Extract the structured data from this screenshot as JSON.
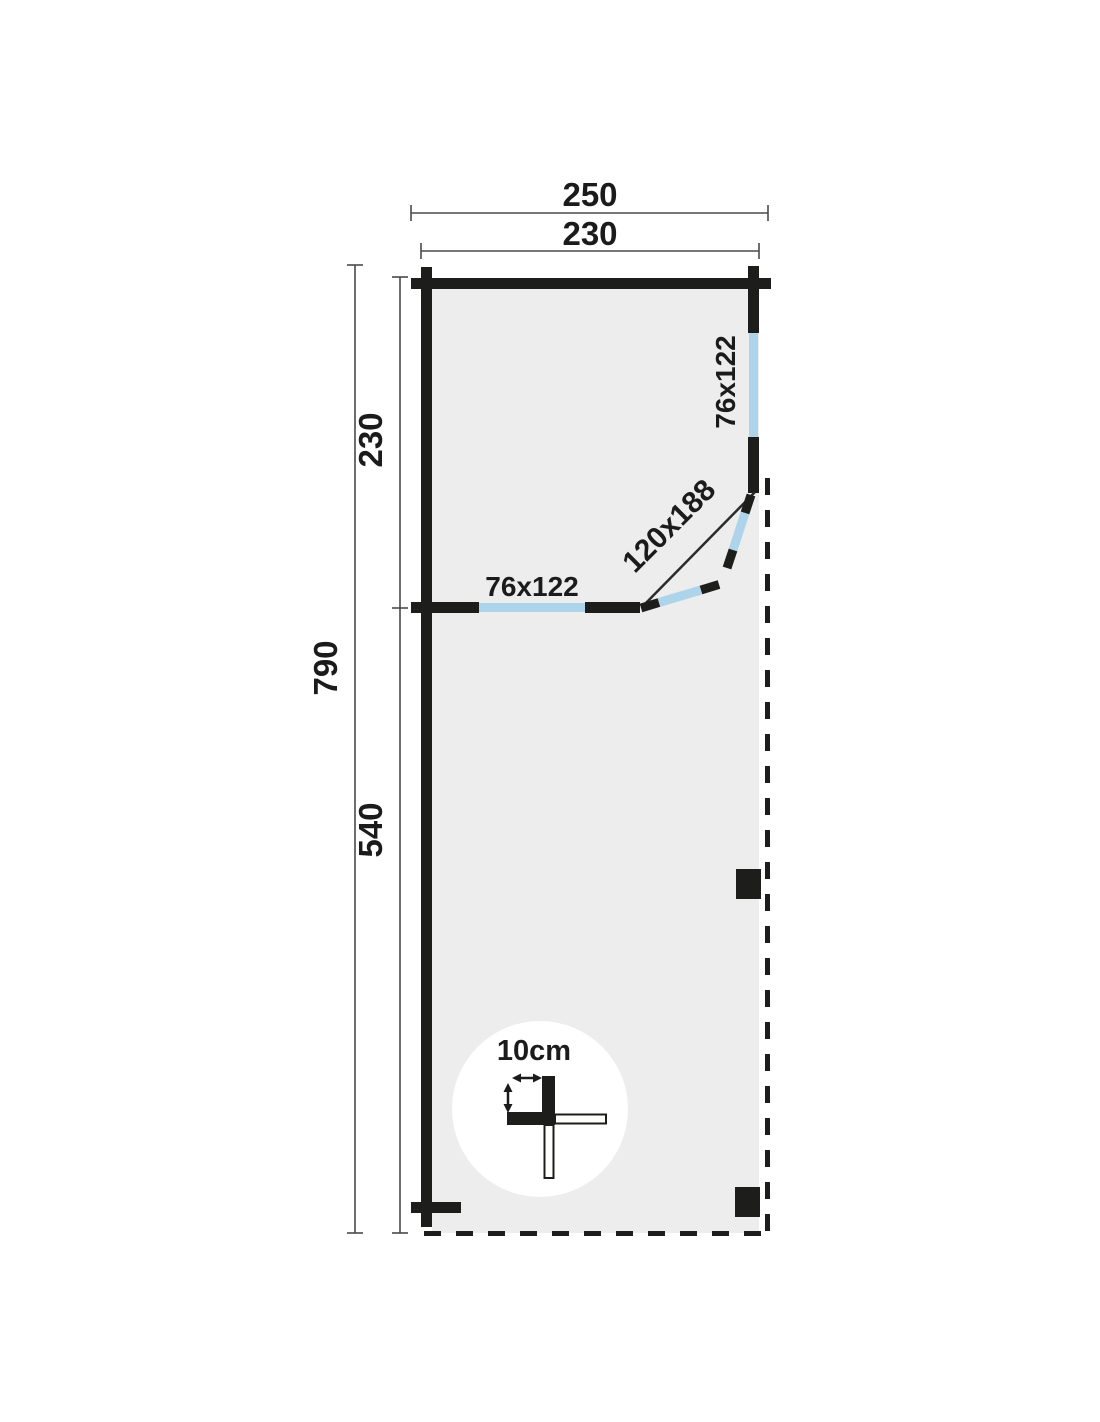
{
  "colors": {
    "wall": "#1d1d1b",
    "window": "#aed4ec",
    "floor": "#ededed",
    "dim_line": "#4a4a4a",
    "background": "#ffffff"
  },
  "dimensions": {
    "overall_width": "250",
    "wall_length": "230",
    "overall_depth": "790",
    "cabin_depth": "230",
    "canopy_depth": "540"
  },
  "openings": {
    "side_window_size": "76x122",
    "front_window_size": "76x122",
    "corner_door_size": "120x188"
  },
  "detail": {
    "wall_thickness": "10cm"
  }
}
